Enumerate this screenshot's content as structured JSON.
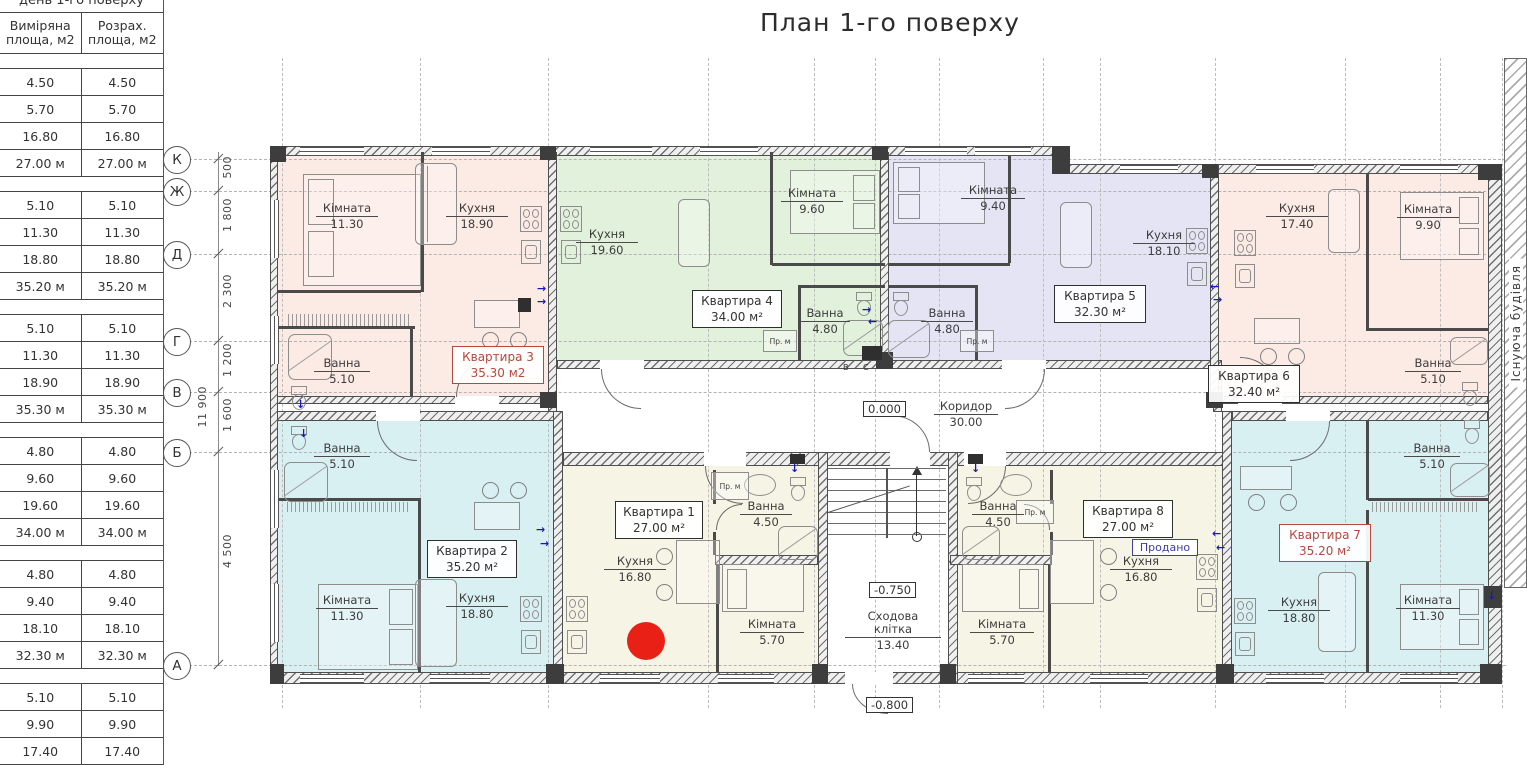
{
  "title": "План 1-го поверху",
  "table": {
    "clipped_title": "день 1-го поверху",
    "headers": [
      "Виміряна площа, м2",
      "Розрах. площа, м2"
    ],
    "groups": [
      {
        "rows": [
          [
            "4.50",
            "4.50"
          ],
          [
            "5.70",
            "5.70"
          ],
          [
            "16.80",
            "16.80"
          ]
        ],
        "total": [
          "27.00 м",
          "27.00 м"
        ]
      },
      {
        "rows": [
          [
            "5.10",
            "5.10"
          ],
          [
            "11.30",
            "11.30"
          ],
          [
            "18.80",
            "18.80"
          ]
        ],
        "total": [
          "35.20 м",
          "35.20 м"
        ]
      },
      {
        "rows": [
          [
            "5.10",
            "5.10"
          ],
          [
            "11.30",
            "11.30"
          ],
          [
            "18.90",
            "18.90"
          ]
        ],
        "total": [
          "35.30 м",
          "35.30 м"
        ]
      },
      {
        "rows": [
          [
            "4.80",
            "4.80"
          ],
          [
            "9.60",
            "9.60"
          ],
          [
            "19.60",
            "19.60"
          ]
        ],
        "total": [
          "34.00 м",
          "34.00 м"
        ]
      },
      {
        "rows": [
          [
            "4.80",
            "4.80"
          ],
          [
            "9.40",
            "9.40"
          ],
          [
            "18.10",
            "18.10"
          ]
        ],
        "total": [
          "32.30 м",
          "32.30 м"
        ]
      },
      {
        "rows": [
          [
            "5.10",
            "5.10"
          ],
          [
            "9.90",
            "9.90"
          ],
          [
            "17.40",
            "17.40"
          ]
        ],
        "total": null
      }
    ]
  },
  "axes": {
    "rows": [
      "К",
      "Ж",
      "Д",
      "Г",
      "В",
      "Б",
      "А"
    ],
    "dims": [
      "500",
      "1 800",
      "2 300",
      "1 200",
      "1 600",
      "4 500"
    ],
    "overall": "11 900"
  },
  "apartments": {
    "a1": {
      "label": "Квартира 1",
      "area": "27.00 м²",
      "rooms": {
        "kitchen": {
          "n": "Кухня",
          "v": "16.80"
        },
        "bath": {
          "n": "Ванна",
          "v": "4.50"
        },
        "room": {
          "n": "Кімната",
          "v": "5.70"
        }
      }
    },
    "a2": {
      "label": "Квартира 2",
      "area": "35.20 м²",
      "rooms": {
        "bath": {
          "n": "Ванна",
          "v": "5.10"
        },
        "room": {
          "n": "Кімната",
          "v": "11.30"
        },
        "kitchen": {
          "n": "Кухня",
          "v": "18.80"
        }
      }
    },
    "a3": {
      "label": "Квартира 3",
      "area": "35.30 м2",
      "rooms": {
        "room": {
          "n": "Кімната",
          "v": "11.30"
        },
        "kitchen": {
          "n": "Кухня",
          "v": "18.90"
        },
        "bath": {
          "n": "Ванна",
          "v": "5.10"
        }
      }
    },
    "a4": {
      "label": "Квартира 4",
      "area": "34.00 м²",
      "rooms": {
        "kitchen": {
          "n": "Кухня",
          "v": "19.60"
        },
        "room": {
          "n": "Кімната",
          "v": "9.60"
        },
        "bath": {
          "n": "Ванна",
          "v": "4.80"
        }
      }
    },
    "a5": {
      "label": "Квартира 5",
      "area": "32.30 м²",
      "rooms": {
        "room": {
          "n": "Кімната",
          "v": "9.40"
        },
        "kitchen": {
          "n": "Кухня",
          "v": "18.10"
        },
        "bath": {
          "n": "Ванна",
          "v": "4.80"
        }
      }
    },
    "a6": {
      "label": "Квартира 6",
      "area": "32.40 м²",
      "rooms": {
        "kitchen": {
          "n": "Кухня",
          "v": "17.40"
        },
        "room": {
          "n": "Кімната",
          "v": "9.90"
        },
        "bath": {
          "n": "Ванна",
          "v": "5.10"
        }
      }
    },
    "a7": {
      "label": "Квартира 7",
      "area": "35.20 м²",
      "rooms": {
        "bath": {
          "n": "Ванна",
          "v": "5.10"
        },
        "kitchen": {
          "n": "Кухня",
          "v": "18.80"
        },
        "room": {
          "n": "Кімната",
          "v": "11.30"
        }
      }
    },
    "a8": {
      "label": "Квартира 8",
      "area": "27.00 м²",
      "rooms": {
        "bath": {
          "n": "Ванна",
          "v": "4.50"
        },
        "kitchen": {
          "n": "Кухня",
          "v": "16.80"
        },
        "room": {
          "n": "Кімната",
          "v": "5.70"
        }
      }
    }
  },
  "common": {
    "corridor": {
      "n": "Коридор",
      "v": "30.00"
    },
    "stairs": {
      "n": "Сходова клітка",
      "v": "13.40"
    }
  },
  "levels": {
    "zero": "0.000",
    "upper": "-0.750",
    "entry": "-0.800"
  },
  "annotations": {
    "existing": "Існуюча будівля",
    "washer": "Пр. м",
    "riser_v": "В",
    "riser_c": "С",
    "sold": "Продано"
  },
  "colors": {
    "pink": "#fceae4",
    "green": "#e1f1db",
    "lavender": "#e4e4f5",
    "cyan": "#d9f0f3",
    "cream": "#f6f4e4",
    "marker": "#e92015",
    "label_red": "#b5483f",
    "label_blue": "#3d3dae"
  }
}
